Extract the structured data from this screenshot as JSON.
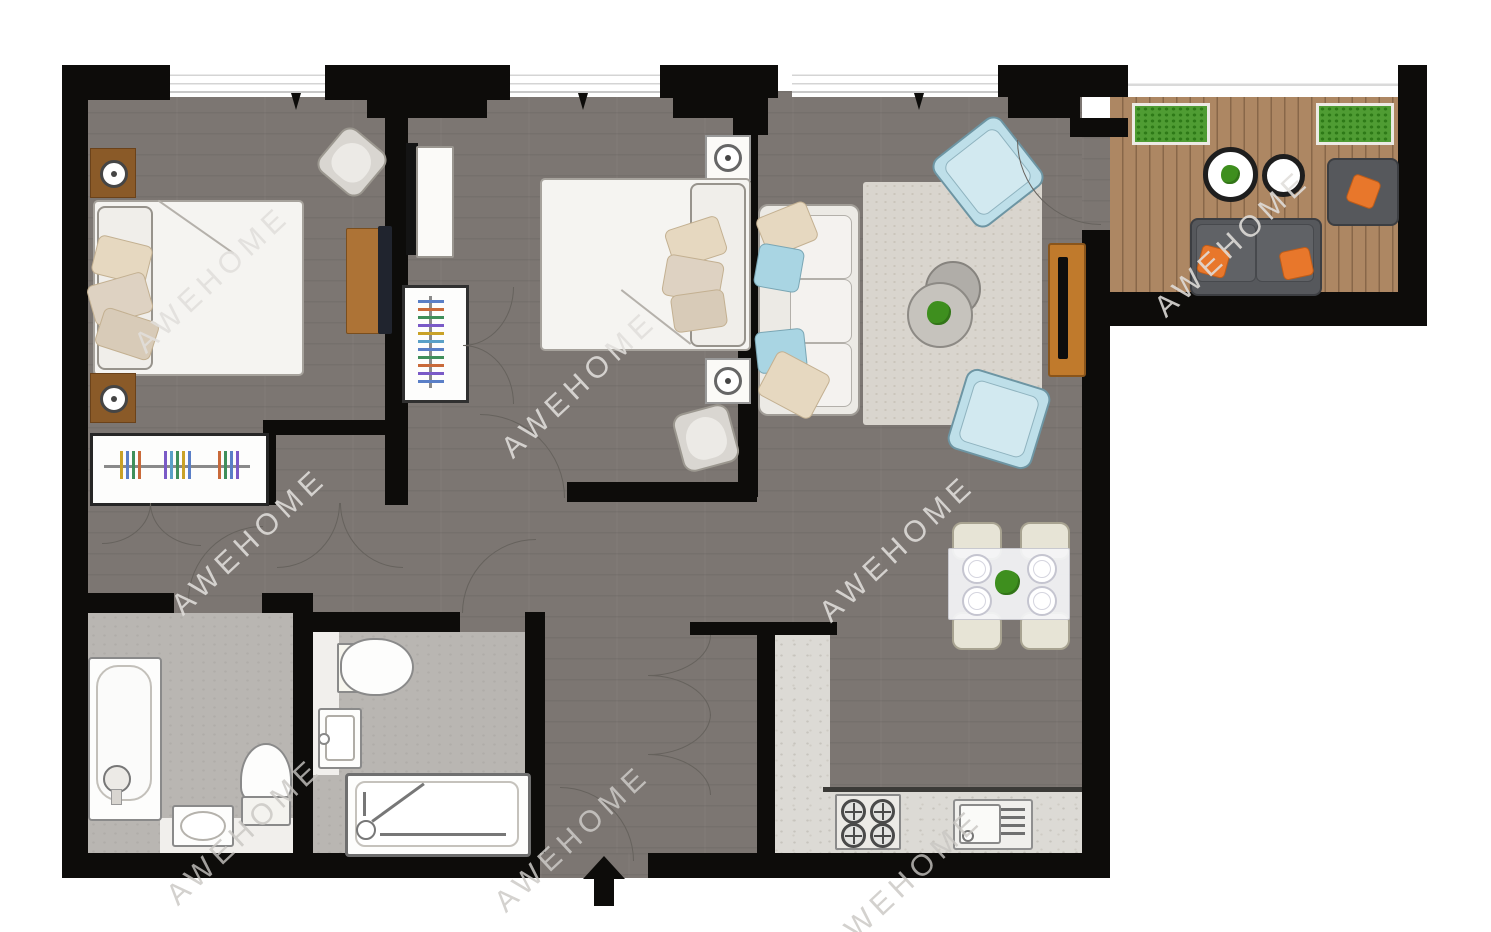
{
  "watermark": {
    "text": "AWEHOME",
    "instances": 8,
    "style": "diagonal translucent"
  },
  "palette": {
    "wall": "#0d0c0a",
    "floor_wood_dark": "#7c7672",
    "bathroom_floor": "#b9b6b2",
    "kitchen_counter": "#dcdad5",
    "balcony_deck": "#ad8763",
    "rug": "#d9d5ce",
    "fixture_white": "#fdfdfc",
    "sofa_cream": "#f1efec",
    "accent_blue": "#a9d5e3",
    "accent_orange": "#e8772b",
    "nightstand_brown": "#8a5a28",
    "tv_unit_wood": "#c07a2c",
    "balcony_furniture_gray": "#56585c",
    "plant_green": "#3e8f1e",
    "planter_green": "#4f9c33"
  },
  "rooms": {
    "bedroom_1": {
      "furniture": [
        "double-bed",
        "nightstand-with-lamp-top",
        "nightstand-with-lamp-bottom",
        "armchair",
        "dresser",
        "wardrobe-with-hangers"
      ]
    },
    "bedroom_2": {
      "furniture": [
        "double-bed",
        "nightstand-with-lamp-top",
        "nightstand-with-lamp-bottom",
        "armchair",
        "console-unit",
        "wardrobe-with-hangers"
      ]
    },
    "living_dining": {
      "furniture": [
        "sofa-with-pillows",
        "area-rug",
        "coffee-tables-round",
        "plant",
        "armchair-blue-top",
        "armchair-blue-bottom",
        "tv-unit",
        "dining-table-for-four",
        "dining-chairs"
      ]
    },
    "kitchen": {
      "furniture": [
        "l-shaped-counter",
        "hob-4-burners",
        "sink-with-drainer"
      ]
    },
    "bathroom_1": {
      "furniture": [
        "bathtub",
        "washbasin",
        "toilet",
        "vanity-strip"
      ]
    },
    "bathroom_2": {
      "furniture": [
        "toilet",
        "washbasin",
        "shower-tray"
      ]
    },
    "balcony": {
      "furniture": [
        "planter-left",
        "planter-right",
        "round-table-with-plant",
        "round-table",
        "outdoor-sofa-orange-pillows",
        "outdoor-armchair-orange-pillow"
      ]
    },
    "hallway": {
      "features": [
        "entry-door-swing",
        "closet-bifold-doors",
        "bedroom-door-swings",
        "bathroom-door-swings"
      ]
    }
  },
  "markers": {
    "entry_arrow_direction": "up",
    "window_openings": 4,
    "window_pane_arrows": 3,
    "door_swing_arcs": 14
  }
}
